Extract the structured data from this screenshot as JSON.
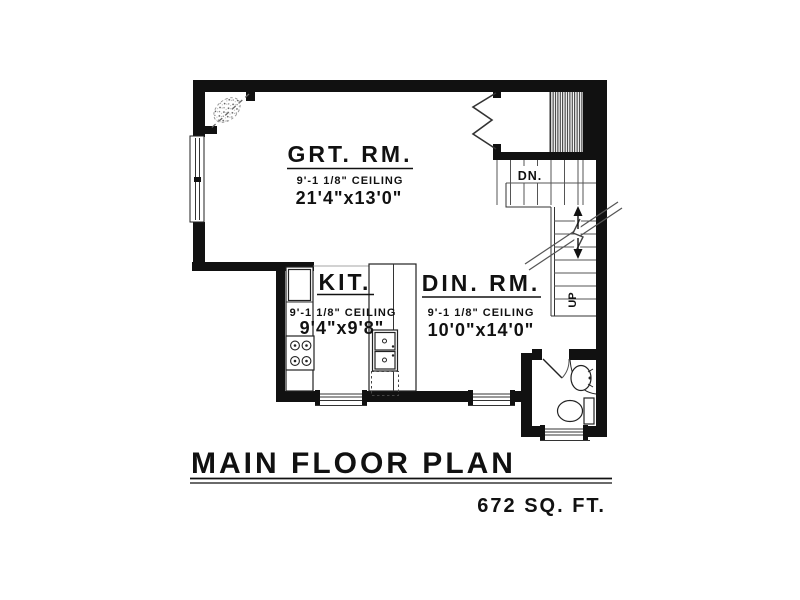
{
  "drawing": {
    "title": "MAIN FLOOR PLAN",
    "area": "672 SQ. FT.",
    "rooms": {
      "great_room": {
        "name": "GRT. RM.",
        "ceiling": "9'-1 1/8\" CEILING",
        "size": "21'4\"x13'0\""
      },
      "kitchen": {
        "name": "KIT.",
        "ceiling": "9'-1 1/8\" CEILING",
        "size": "9'4\"x9'8\""
      },
      "dining_room": {
        "name": "DIN. RM.",
        "ceiling": "9'-1 1/8\" CEILING",
        "size": "10'0\"x14'0\""
      }
    },
    "stairs": {
      "down_label": "DN.",
      "up_label": "UP"
    },
    "colors": {
      "ink": "#111111",
      "line": "#444444",
      "paper": "#ffffff"
    }
  }
}
